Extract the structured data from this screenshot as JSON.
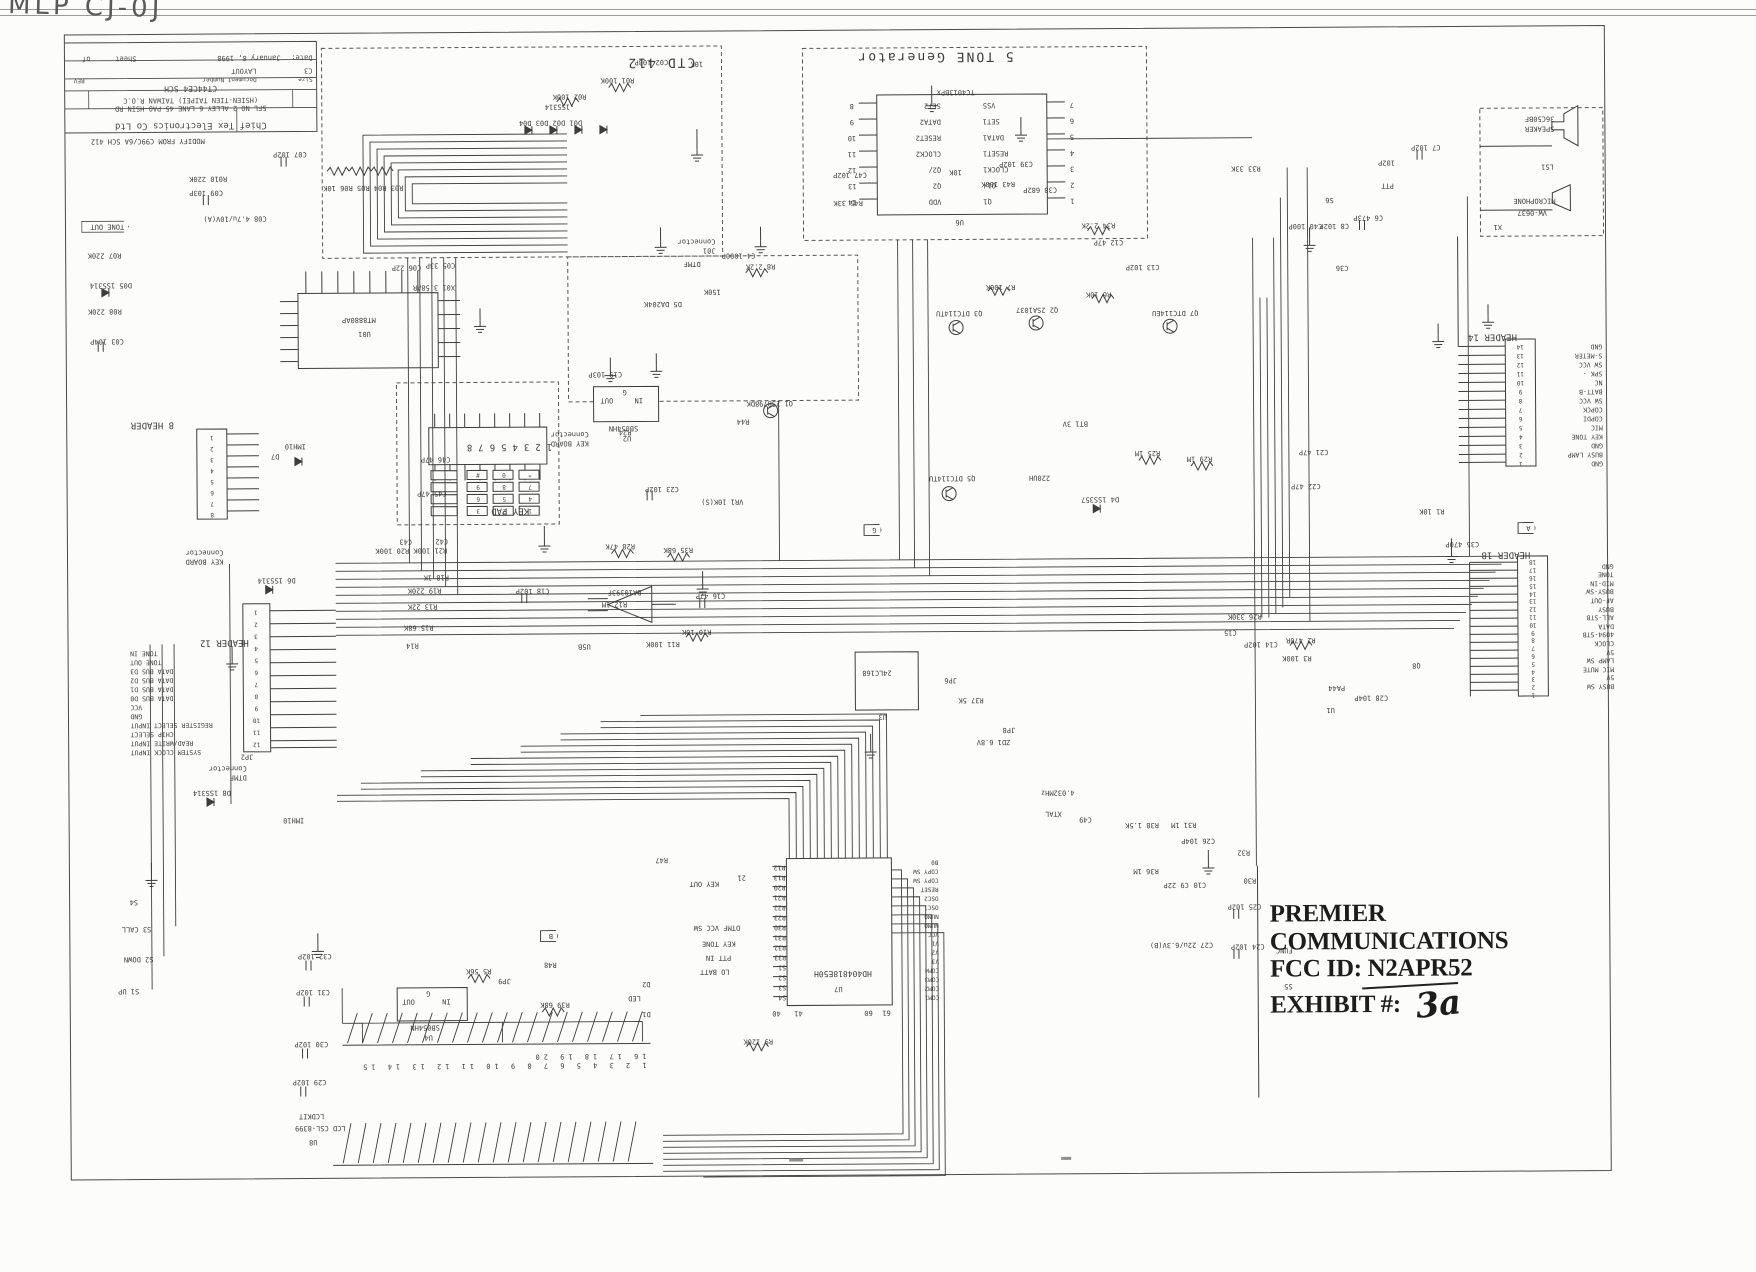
{
  "stamp": {
    "line1": "PREMIER COMMUNICATIONS",
    "line2": "FCC ID:  N2APR52",
    "line3": "EXHIBIT #:",
    "handwritten": "3a"
  },
  "corner_scribble": "MLP CJ-0J",
  "title_block": {
    "company": "Chief Tex Electronics Co Ltd",
    "address1": "5FL NO 2 ALLEY 6 LANE 45 PAO HSIN RD",
    "address2": "(HSIEN-TIEN TAIPEI) TAIWAN R.O.C",
    "title_value": "CT44CE4 SCH",
    "size_label": "Size",
    "docnum_label": "Document Number",
    "rev_label": "REV",
    "size_value": "C3",
    "docnum_value": "LAYOUT",
    "date_label": "Date:",
    "date_value": "January 8, 1998",
    "sheet_label": "Sheet",
    "of_label": "of"
  },
  "boxes": {
    "ctd412": "CTD 412",
    "tone_gen": "5 TONE Generator",
    "key_pad": "KEY PAD"
  },
  "speaker": {
    "part": "36C50BF",
    "name": "SPEAKER",
    "ref": "LS1",
    "mic_name": "MICROPHONE",
    "mic_part": "VW-0637",
    "mic_ref": "X1"
  },
  "u6": {
    "ref": "U6",
    "part": "TC4013BPx",
    "left_names": [
      "VDD",
      "Q2",
      "Q2/",
      "CLOCK2",
      "RESET2",
      "DATA2",
      "SET2"
    ],
    "left_nums": [
      "14",
      "13",
      "12",
      "11",
      "10",
      "9",
      "8"
    ],
    "right_names": [
      "Q1",
      "Q1/",
      "CLOCK1",
      "RESET1",
      "DATA1",
      "SET1",
      "VSS"
    ],
    "right_nums": [
      "1",
      "2",
      "3",
      "4",
      "5",
      "6",
      "7"
    ]
  },
  "u01": {
    "ref": "U01",
    "part": "MT8880AP"
  },
  "u2": {
    "ref": "U2",
    "part": "SB054HN",
    "pin_in": "IN",
    "pin_out": "OUT",
    "pin_g": "G"
  },
  "u4": {
    "ref": "U4",
    "part": "SB054HN",
    "pin_in": "IN",
    "pin_out": "OUT",
    "pin_g": "G"
  },
  "u3": {
    "ref": "U3",
    "part": "24LC168"
  },
  "u5": {
    "ref": "U5B",
    "part": "BA10393F"
  },
  "u7": {
    "ref": "U7",
    "part": "HD404818E50H",
    "left_pins": [
      "S4",
      "S3",
      "S2",
      "S1",
      "R33",
      "R32",
      "R31",
      "R30",
      "R23",
      "R22",
      "R21",
      "R20",
      "R13",
      "R12"
    ],
    "right_pins": [
      "COM1",
      "COM2",
      "COM3",
      "COM4",
      "V3",
      "V2",
      "V1",
      "VCC",
      "NUM0",
      "NUM0",
      "OSC1",
      "OSC2",
      "RESET",
      "COPY SW",
      "COPY SW",
      "B0"
    ],
    "sig_key_out": "KEY OUT",
    "pin21": "21",
    "sig_dtmf": "DTMF VCC SW",
    "sig_keytone": "KEY TONE",
    "sig_ptt": "PTT IN",
    "sig_lobatt": "LO BATT",
    "pin40": "40",
    "pin41": "41",
    "pin60": "60",
    "pin61": "61"
  },
  "u8": {
    "ref": "U8",
    "part": "LCD CSL-8399",
    "kit": "LCDKIT",
    "numbers": "1 2 3 4 5 6 7 8 9 10 11 12 13 14 15 16 17 18 19 20"
  },
  "kb": {
    "nums": "12345678",
    "keys": [
      [
        "1",
        "2",
        "3"
      ],
      [
        "4",
        "5",
        "6"
      ],
      [
        "7",
        "8",
        "9"
      ],
      [
        "*",
        "0",
        "#"
      ]
    ]
  },
  "header8": {
    "title": "8 HEADER",
    "pins": [
      "8",
      "7",
      "6",
      "5",
      "4",
      "3",
      "2",
      "1"
    ]
  },
  "header12": {
    "title": "HEADER 12",
    "ref": "JP2",
    "conn": [
      "DTMF",
      "Connector"
    ],
    "pins": [
      "12",
      "11",
      "10",
      "9",
      "8",
      "7",
      "6",
      "5",
      "4",
      "3",
      "2",
      "1"
    ],
    "sigs": [
      "SYSTEM CLOCK INPUT",
      "READ/WRITE INPUT",
      "CHIP SELECT",
      "REGISTER SELECT INPUT",
      "GND",
      "VCC",
      "DATA BUS D0",
      "DATA BUS D1",
      "DATA BUS D2",
      "DATA BUS D3",
      "TONE OUT",
      "TONE IN"
    ]
  },
  "header14": {
    "title": "HEADER 14",
    "pins": [
      "1",
      "2",
      "3",
      "4",
      "5",
      "6",
      "7",
      "8",
      "9",
      "10",
      "11",
      "12",
      "13",
      "14"
    ],
    "sigs": [
      "GND",
      "BUSY LAMP",
      "GND",
      "KEY TONE",
      "MIC",
      "COPDI",
      "COPCK",
      "SW VCC",
      "BATT-B",
      "NC",
      "SPK -",
      "SW VCC",
      "S-METER",
      "GND"
    ]
  },
  "header18": {
    "title": "HEADER 18",
    "pins": [
      "1",
      "2",
      "3",
      "4",
      "5",
      "6",
      "7",
      "8",
      "9",
      "10",
      "11",
      "12",
      "13",
      "14",
      "15",
      "16",
      "17",
      "18"
    ],
    "sigs": [
      "BUSY SW",
      "5V",
      "MIC MUTE",
      "LAMP SW",
      "5V",
      "CLOCK",
      "4094-STB",
      "DATA",
      "ALL-STB",
      "BUSY",
      "AF-OUT",
      "BUSY-SW",
      "MID-IN",
      "TONE",
      "GND"
    ]
  },
  "flags": {
    "tone_out": "TONE OUT",
    "a": "A",
    "b": "B",
    "g": "G"
  },
  "labels": {
    "l00": "C07 102P",
    "l01": "R010 220K",
    "l02": "C09 103P",
    "l03": "C08 4.7u/10V(A)",
    "l04": "R07 220K",
    "l05": "D05 1SS314",
    "l06": "R08 220K",
    "l07": "C03 104P",
    "l08": "X01 3.58AR",
    "l09": "C05 33P",
    "l10": "C06 22P",
    "l11": "D01 D02 D03 D04",
    "l12": "-1SS314",
    "l13": "R03 R04 R05 R06 10K",
    "l14": "R01 100K",
    "l15": "C02 103P",
    "l16": "R02 100K",
    "l17": "10K",
    "l18": "C47 102P",
    "l19": "R45 33K",
    "l20": "10K",
    "l21": "C39 102P",
    "l22": "R43 100K",
    "l23": "C38 682P",
    "l24": "R33 33K",
    "l25": "C7 102P",
    "l26": "C40 100P",
    "l27": "C8 102P",
    "l28": "PTT",
    "l29": "S6",
    "l30": "C6 473P",
    "l31": "102P",
    "l32": "C13 102P",
    "l33": "R34 2.2K",
    "l34": "C12 47P",
    "l35": "R6 10K",
    "l36": "R7 100K",
    "l37": "Q2 2SA1037",
    "l38": "Q3 DTC114TU",
    "l39": "Q7 DTC114EU",
    "l40": "C36",
    "l41": "R8 2.2K",
    "l42": "C4 1000P",
    "l43": "150K",
    "l44": "D5 DA204K",
    "l45": "Q1 2SB798DK",
    "l46": "R44",
    "l47": "C19 103P",
    "l48": "R24",
    "l49": "C23 102P",
    "l50": "VR1 10K(S)",
    "l51": "R28 47K",
    "l52": "R35 68K",
    "l53": "C16 47P",
    "l54": "R10 10K",
    "l55": "R11 100K",
    "l56": "R12 1M",
    "l57": "C18 102P",
    "l58": "R20 100K",
    "l59": "R21 100K",
    "l60": "R19 220K",
    "l61": "R18 1K",
    "l62": "R13 22K",
    "l63": "R15 68K",
    "l64": "R14",
    "l65": "C42",
    "l66": "C43",
    "l67": "R37 5K",
    "l68": "JP6",
    "l69": "JP8",
    "l70": "ZD1 6.8V",
    "l71": "R38 1.5K",
    "l72": "R31 1M",
    "l73": "C26 104P",
    "l74": "R36 1M",
    "l75": "C9 22P",
    "l76": "C10",
    "l77": "XTAL",
    "l78": "4.032MHz",
    "l79": "C49",
    "l80": "C27 22u/6.3V(B)",
    "l81": "R32",
    "l82": "R30",
    "l83": "C25 102P",
    "l84": "FUNC",
    "l85": "C24 102P",
    "l86": "S5",
    "l87": "R9 120K",
    "l88": "D2",
    "l89": "D1",
    "l90": "LED",
    "l91": "S4",
    "l92": "S3 CALL",
    "l93": "S2 DOWN",
    "l94": "S1 UP",
    "l95": "C32 102P",
    "l96": "C31 102P",
    "l97": "C30 102P",
    "l98": "C29 102P",
    "l99": "R5 56K",
    "l100": "JP9",
    "l101": "R48",
    "l102": "R39 68K",
    "l103": "R47",
    "l104": "BT1 3V",
    "l105": "D4 1SS357",
    "l106": "220UH",
    "l107": "Q5 DTC114TU",
    "l108": "R25 1M",
    "l109": "R29 1M",
    "l110": "C21 47P",
    "l111": "C22 47P",
    "l112": "R1 10K",
    "l113": "C35 470P",
    "l114": "R2 470R",
    "l115": "R3 100K",
    "l116": "C28 104P",
    "l117": "U1",
    "l118": "PA44",
    "l119": "Q8",
    "l120": "R26 330K",
    "l121": "C14 102P",
    "l122": "C15",
    "l123": "C45 47P",
    "l124": "C46 47P",
    "l125": "D7",
    "l126": "IMH10",
    "l127": "IMH10",
    "l128": "D6 1SS314",
    "l129": "D8 1SS314",
    "l130": "8 HEADER",
    "l131": [
      "KEY BOARD",
      "Connector"
    ],
    "l132": [
      "KEY BOARD",
      "Connector"
    ],
    "l133": "KEY PAD",
    "l134": "MODIFY FROM C99C/6A SCH 412",
    "l135": "DTMF",
    "l136": [
      "J01",
      "Connector"
    ],
    "l137": "BA10393F",
    "l138": "U5B"
  }
}
